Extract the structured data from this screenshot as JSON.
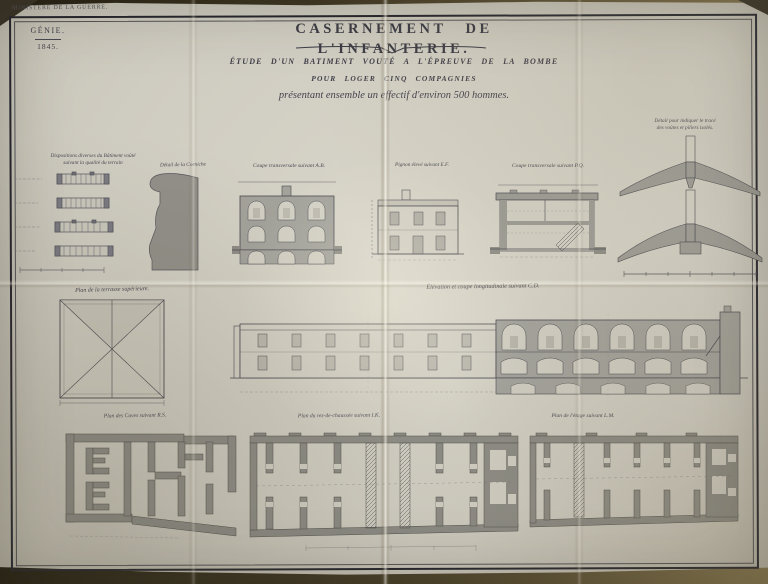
{
  "palette": {
    "backdrop": "#3c3522",
    "paper": "#cfccc1",
    "ink": "#3b3a44",
    "wash": "#9c9b94"
  },
  "header": {
    "ministry": "MINISTÈRE DE LA GUERRE.",
    "corps": "GÉNIE.",
    "year": "1845.",
    "title": "CASERNEMENT DE L'INFANTERIE.",
    "subtitle_line1": "ÉTUDE D'UN BATIMENT VOUTÉ A L'ÉPREUVE DE LA BOMBE",
    "subtitle_line2": "POUR LOGER CINQ COMPAGNIES",
    "subtitle_line3": "présentant ensemble un effectif d'environ 500 hommes."
  },
  "drawings": {
    "dispositions": {
      "label_line1": "Dispositions diverses du Bâtiment voûté",
      "label_line2": "suivant la qualité du terrain"
    },
    "cornice_detail": {
      "label": "Détail de la Corniche"
    },
    "coupe_ab": {
      "label": "Coupe transversale suivant A.B."
    },
    "pignon": {
      "label": "Pignon élevé suivant E.F."
    },
    "coupe_pq": {
      "label": "Coupe transversale suivant P.Q."
    },
    "vault_detail": {
      "label_line1": "Détail pour indiquer le tracé",
      "label_line2": "des voûtes et piliers isolés."
    },
    "terrace_plan": {
      "label": "Plan de la terrasse supérieure."
    },
    "long_section": {
      "label": "Élévation et coupe longitudinale suivant C.D."
    },
    "caves_plan": {
      "label": "Plan des Caves suivant R.S."
    },
    "ground_plan": {
      "label": "Plan du rez-de-chaussée suivant I.K."
    },
    "upper_plan": {
      "label": "Plan de l'étage suivant L.M."
    }
  }
}
